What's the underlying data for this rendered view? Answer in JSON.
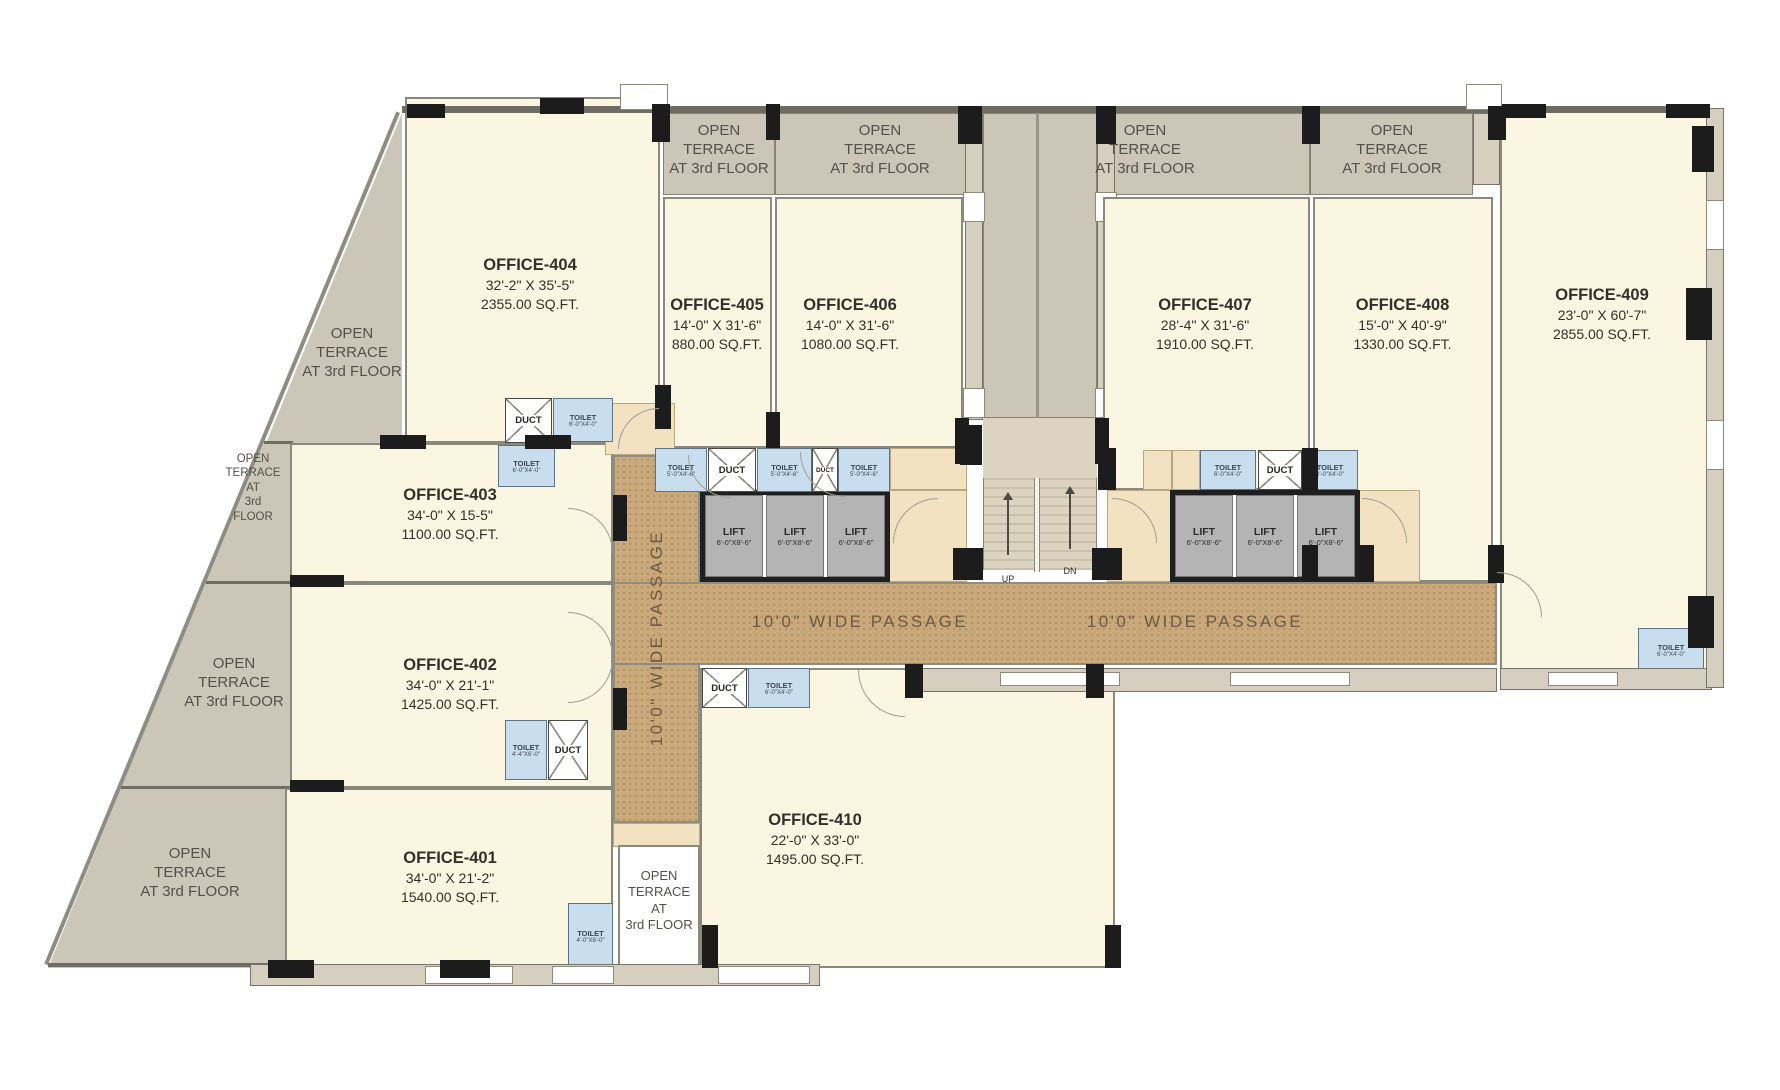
{
  "plan": {
    "rooms": [
      {
        "name": "OFFICE-401",
        "dims": "34'-0\" X 21'-2\"",
        "area": "1540.00 SQ.FT."
      },
      {
        "name": "OFFICE-402",
        "dims": "34'-0\" X 21'-1\"",
        "area": "1425.00 SQ.FT."
      },
      {
        "name": "OFFICE-403",
        "dims": "34'-0\" X 15-5\"",
        "area": "1100.00 SQ.FT."
      },
      {
        "name": "OFFICE-404",
        "dims": "32'-2\" X 35'-5\"",
        "area": "2355.00 SQ.FT."
      },
      {
        "name": "OFFICE-405",
        "dims": "14'-0\" X 31'-6\"",
        "area": "880.00 SQ.FT."
      },
      {
        "name": "OFFICE-406",
        "dims": "14'-0\" X 31'-6\"",
        "area": "1080.00 SQ.FT."
      },
      {
        "name": "OFFICE-407",
        "dims": "28'-4\" X 31'-6\"",
        "area": "1910.00 SQ.FT."
      },
      {
        "name": "OFFICE-408",
        "dims": "15'-0\" X 40'-9\"",
        "area": "1330.00 SQ.FT."
      },
      {
        "name": "OFFICE-409",
        "dims": "23'-0\" X 60'-7\"",
        "area": "2855.00 SQ.FT."
      },
      {
        "name": "OFFICE-410",
        "dims": "22'-0\" X 33'-0\"",
        "area": "1495.00 SQ.FT."
      }
    ],
    "terrace_label_3": "OPEN\nTERRACE\nAT 3rd FLOOR",
    "terrace_label_5": "OPEN\nTERRACE\nAT\n3rd\nFLOOR",
    "terrace_label_4": "OPEN\nTERRACE\nAT\n3rd FLOOR",
    "passage_label": "10'0\" WIDE PASSAGE",
    "lift": {
      "label": "LIFT",
      "size": "6'-0\"X8'-6\""
    },
    "duct_label": "DUCT",
    "toilet_label": "TOILET",
    "toilet_sizes": {
      "a": "6'-0\"X4'-0\"",
      "b": "5'-0\"X4'-6\"",
      "c": "4'-4\"X6'-0\"",
      "d": "4'-0\"X6'-0\""
    },
    "stairs": {
      "up": "UP",
      "down": "DN"
    },
    "colors": {
      "room": "#FAF6E2",
      "terrace": "#CCC6B9",
      "passage": "#C9A87C",
      "toilet": "#C8DDEE",
      "lift": "#B4B4B4",
      "lobby": "#F2E2C2",
      "wall": "#6E6C63",
      "column": "#1C1C1C"
    }
  }
}
